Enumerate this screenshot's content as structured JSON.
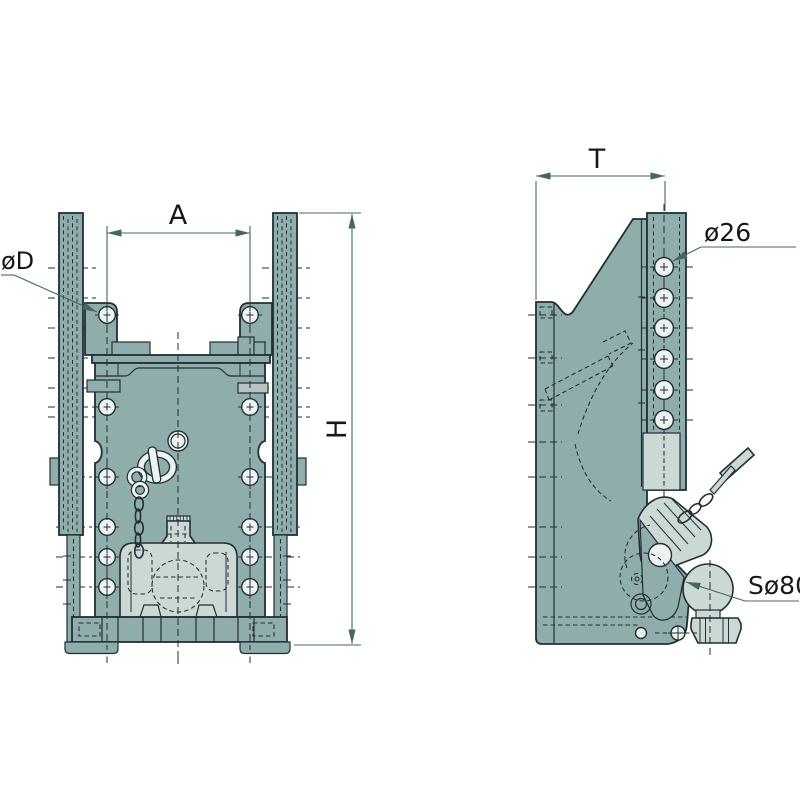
{
  "drawing": {
    "type": "technical-drawing-two-view-ball-hitch",
    "labels": {
      "hole_spacing": "A",
      "height": "H",
      "depth": "T",
      "hole_front": "øD",
      "hole_side": "ø26",
      "ball": "Sø80"
    },
    "colors": {
      "body": "#8fadaa",
      "light_parts": "#cbd8d4",
      "hole_fill": "#eef2f0",
      "outline": "#232e36",
      "dimension_lines": "#44685e",
      "text": "#15191d",
      "background": "#ffffff"
    }
  }
}
